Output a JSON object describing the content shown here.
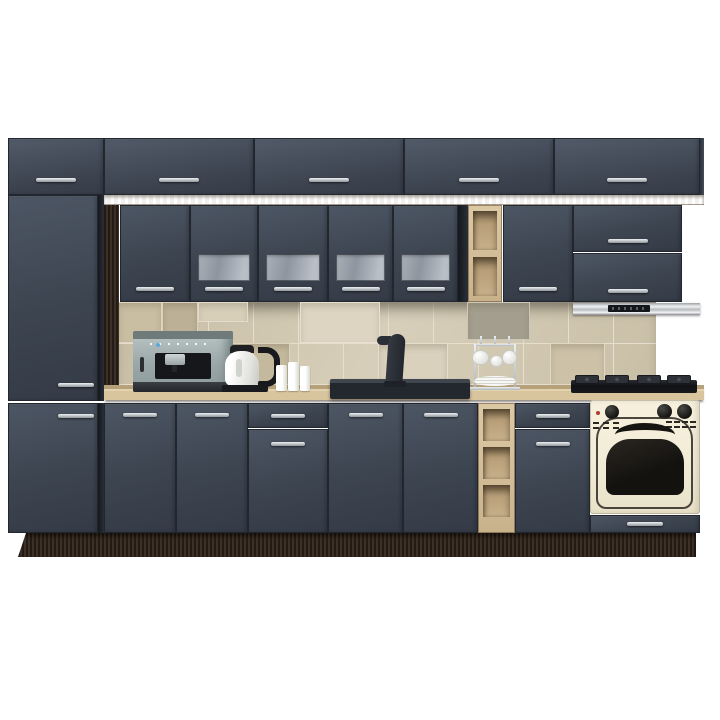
{
  "colors": {
    "bg": "#ffffff",
    "graphite": "#3d4551",
    "graphite-light": "#4d5664",
    "graphite-dark": "#2c323c",
    "seam": "#22262e",
    "handle-light": "#eef1f3",
    "handle-dark": "#8e959c",
    "oak": "#c8b28c",
    "oak-light": "#dcc9a5",
    "oak-dark": "#a08a66",
    "wenge": "#362a21",
    "wenge-dark": "#271d16",
    "tile": "#d2c8b0",
    "tile-grout": "#e6dfcd",
    "glass-light": "#b9bfc7",
    "glass-dark": "#8d959f",
    "steel-light": "#f0f1f2",
    "steel-dark": "#86898d",
    "cream": "#f2ecd8",
    "oven-black": "#1c1a17",
    "sink-black": "#23272e",
    "red-indicator": "#b03a2e",
    "kettle-white": "#f5f5f3",
    "chrome": "#d3d8db"
  },
  "scene": {
    "subject": "graphite-grey kitchen cabinet set with sonoma oak accents on white background",
    "upper_modules": [
      "cornice row of five graphite doors",
      "tall pantry column",
      "plain wall cabinet",
      "four wall cabinets with frosted glass band",
      "open oak shelf column",
      "tall wall cabinet",
      "flip-up cabinet over slim extractor hood"
    ],
    "base_modules": [
      "pantry lower door",
      "two-door base cabinet",
      "drawer-over-door cabinet",
      "two-door sink base",
      "open oak shelf column",
      "drawer-over-door cabinet",
      "oven housing with bottom drawer"
    ],
    "appliances": [
      "espresso machine",
      "white electric kettle",
      "black faucet",
      "dark composite sink",
      "mug stand with cups and plates",
      "gas hob",
      "retro cream built-in oven",
      "stainless extractor hood"
    ],
    "decor": [
      "travertine tile backsplash",
      "three white candles",
      "dark wenge plinth and side panel",
      "oak countertop"
    ]
  }
}
